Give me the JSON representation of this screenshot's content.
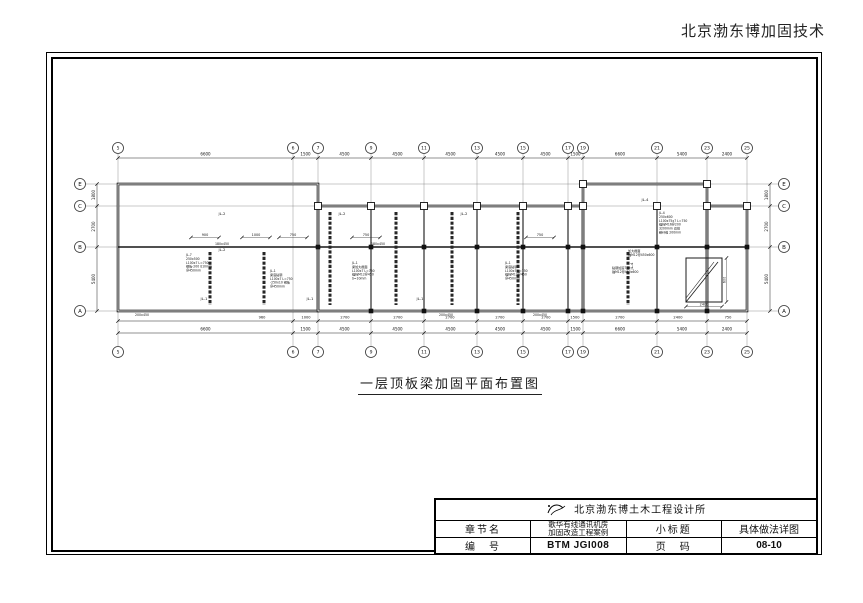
{
  "header": {
    "brand": "北京渤东博加固技术"
  },
  "caption": {
    "title": "一层顶板梁加固平面布置图"
  },
  "title_block": {
    "institute": "北京渤东博土木工程设计所",
    "chapter_label": "章节名",
    "project_line1": "歌华有线通讯机房",
    "project_line2": "加固改造工程案例",
    "subtitle_label": "小标题",
    "subtitle_value": "具体做法详图",
    "number_label": "编　号",
    "number_value": "BTM JGI008",
    "page_label": "页　码",
    "page_value": "08-10"
  },
  "drawing": {
    "axes_v": [
      [
        118,
        "5"
      ],
      [
        293,
        "6"
      ],
      [
        318,
        "7"
      ],
      [
        371,
        "9"
      ],
      [
        424,
        "11"
      ],
      [
        477,
        "13"
      ],
      [
        523,
        "15"
      ],
      [
        568,
        "17"
      ],
      [
        583,
        "19"
      ],
      [
        657,
        "21"
      ],
      [
        707,
        "23"
      ],
      [
        747,
        "25"
      ]
    ],
    "axes_h": [
      [
        184,
        "E"
      ],
      [
        206,
        "C"
      ],
      [
        247,
        "B"
      ],
      [
        311,
        "A"
      ]
    ],
    "dims_top": [
      "6600",
      "1500",
      "4500",
      "4500",
      "4500",
      "4500",
      "4500",
      "1500",
      "6600",
      "5400",
      "2400"
    ],
    "dims_bottom": [
      "6600",
      "1500",
      "4500",
      "4500",
      "4500",
      "4500",
      "4500",
      "1500",
      "6600",
      "5400",
      "2400"
    ],
    "dims_bottom_inner": [
      [
        262,
        "960"
      ],
      [
        306,
        "1000"
      ],
      [
        345,
        "2700"
      ],
      [
        398,
        "2700"
      ],
      [
        450,
        "2700"
      ],
      [
        500,
        "2700"
      ],
      [
        546,
        "2700"
      ],
      [
        575,
        "1500"
      ],
      [
        620,
        "2700"
      ],
      [
        678,
        "2400"
      ],
      [
        728,
        "750"
      ]
    ],
    "dims_left": [
      "1800",
      "2700",
      "5400"
    ],
    "dims_right": [
      "1800",
      "2700",
      "5400"
    ],
    "inner_dims": [
      [
        205,
        236,
        "900"
      ],
      [
        256,
        236,
        "1000"
      ],
      [
        293,
        236,
        "750"
      ],
      [
        366,
        236,
        "750"
      ],
      [
        540,
        236,
        "750"
      ]
    ],
    "walls": [
      [
        118,
        184,
        200,
        127
      ],
      [
        318,
        206,
        265,
        105
      ],
      [
        583,
        184,
        124,
        127
      ],
      [
        707,
        206,
        40,
        105
      ]
    ],
    "partitions": [
      [
        118,
        247,
        318,
        247,
        1.4
      ],
      [
        318,
        247,
        747,
        247,
        1.4
      ],
      [
        371,
        206,
        371,
        311,
        1.1
      ],
      [
        424,
        206,
        424,
        311,
        1.1
      ],
      [
        477,
        206,
        477,
        311,
        1.1
      ],
      [
        523,
        206,
        523,
        311,
        1.1
      ],
      [
        568,
        206,
        568,
        311,
        1.1
      ],
      [
        657,
        206,
        657,
        311,
        1.1
      ]
    ],
    "beams": [
      [
        210,
        252,
        305
      ],
      [
        264,
        252,
        305
      ],
      [
        330,
        212,
        305
      ],
      [
        396,
        212,
        305
      ],
      [
        452,
        212,
        305
      ],
      [
        518,
        212,
        305
      ],
      [
        628,
        252,
        305
      ]
    ],
    "beam_labels": [
      [
        222,
        215,
        "JL-2",
        0
      ],
      [
        342,
        215,
        "JL-2",
        0
      ],
      [
        464,
        215,
        "JL-2",
        0
      ],
      [
        222,
        251,
        "JL-2",
        0
      ],
      [
        204,
        300,
        "JL-1",
        0
      ],
      [
        310,
        300,
        "JL-1",
        0
      ],
      [
        420,
        300,
        "JL-1",
        0
      ],
      [
        645,
        201,
        "JL-4",
        0
      ],
      [
        633,
        266,
        "JL-4",
        -90
      ]
    ],
    "columns": {
      "hollow": [
        [
          318,
          206
        ],
        [
          371,
          206
        ],
        [
          424,
          206
        ],
        [
          477,
          206
        ],
        [
          523,
          206
        ],
        [
          568,
          206
        ],
        [
          583,
          206
        ],
        [
          657,
          206
        ],
        [
          707,
          206
        ],
        [
          747,
          206
        ],
        [
          583,
          184
        ],
        [
          707,
          184
        ]
      ],
      "filled": [
        [
          318,
          247
        ],
        [
          371,
          247
        ],
        [
          424,
          247
        ],
        [
          477,
          247
        ],
        [
          523,
          247
        ],
        [
          568,
          247
        ],
        [
          583,
          247
        ],
        [
          657,
          247
        ],
        [
          707,
          247
        ],
        [
          747,
          247
        ],
        [
          371,
          311
        ],
        [
          424,
          311
        ],
        [
          477,
          311
        ],
        [
          523,
          311
        ],
        [
          568,
          311
        ],
        [
          583,
          311
        ],
        [
          657,
          311
        ],
        [
          707,
          311
        ]
      ]
    },
    "notes": [
      {
        "x": 186,
        "y": 256,
        "lines": [
          "JL-7",
          "250x500",
          "L100x7 L=750",
          "钢板-200 δ10mm",
          "@450mm"
        ]
      },
      {
        "x": 270,
        "y": 272,
        "lines": [
          "JL-1",
          "梁底粘钢",
          "L100x7 L=750",
          "-250x10 钢板",
          "@450mm"
        ]
      },
      {
        "x": 352,
        "y": 264,
        "lines": [
          "JL-1",
          "梁加大截面",
          "L100x7 L=750",
          "锚栓M12@450",
          "δ=10mm"
        ]
      },
      {
        "x": 505,
        "y": 264,
        "lines": [
          "JL-1",
          "梁底粘钢",
          "L100x7 L=750",
          "锚栓M12@450",
          "@450mm"
        ]
      },
      {
        "x": 659,
        "y": 214,
        "lines": [
          "JL-4",
          "250x600",
          "L100x75x7 L=750",
          "锚栓M16@200",
          "3200mm 双排",
          "碳纤维 200mm"
        ]
      },
      {
        "x": 628,
        "y": 252,
        "lines": [
          "加大截面",
          "锚M12@450x600"
        ]
      },
      {
        "x": 612,
        "y": 269,
        "lines": [
          "粘钢加固700",
          "锚M12@450x600"
        ]
      }
    ],
    "callouts": [
      [
        222,
        245,
        "180x450"
      ],
      [
        378,
        245,
        "180x450"
      ],
      [
        142,
        316,
        "200x450"
      ],
      [
        446,
        316,
        "200x450"
      ],
      [
        540,
        316,
        "200x450"
      ]
    ],
    "ramp": {
      "x": 686,
      "y": 258,
      "w": 36,
      "h": 44,
      "dim_w": "2400",
      "dim_h": "600"
    }
  }
}
